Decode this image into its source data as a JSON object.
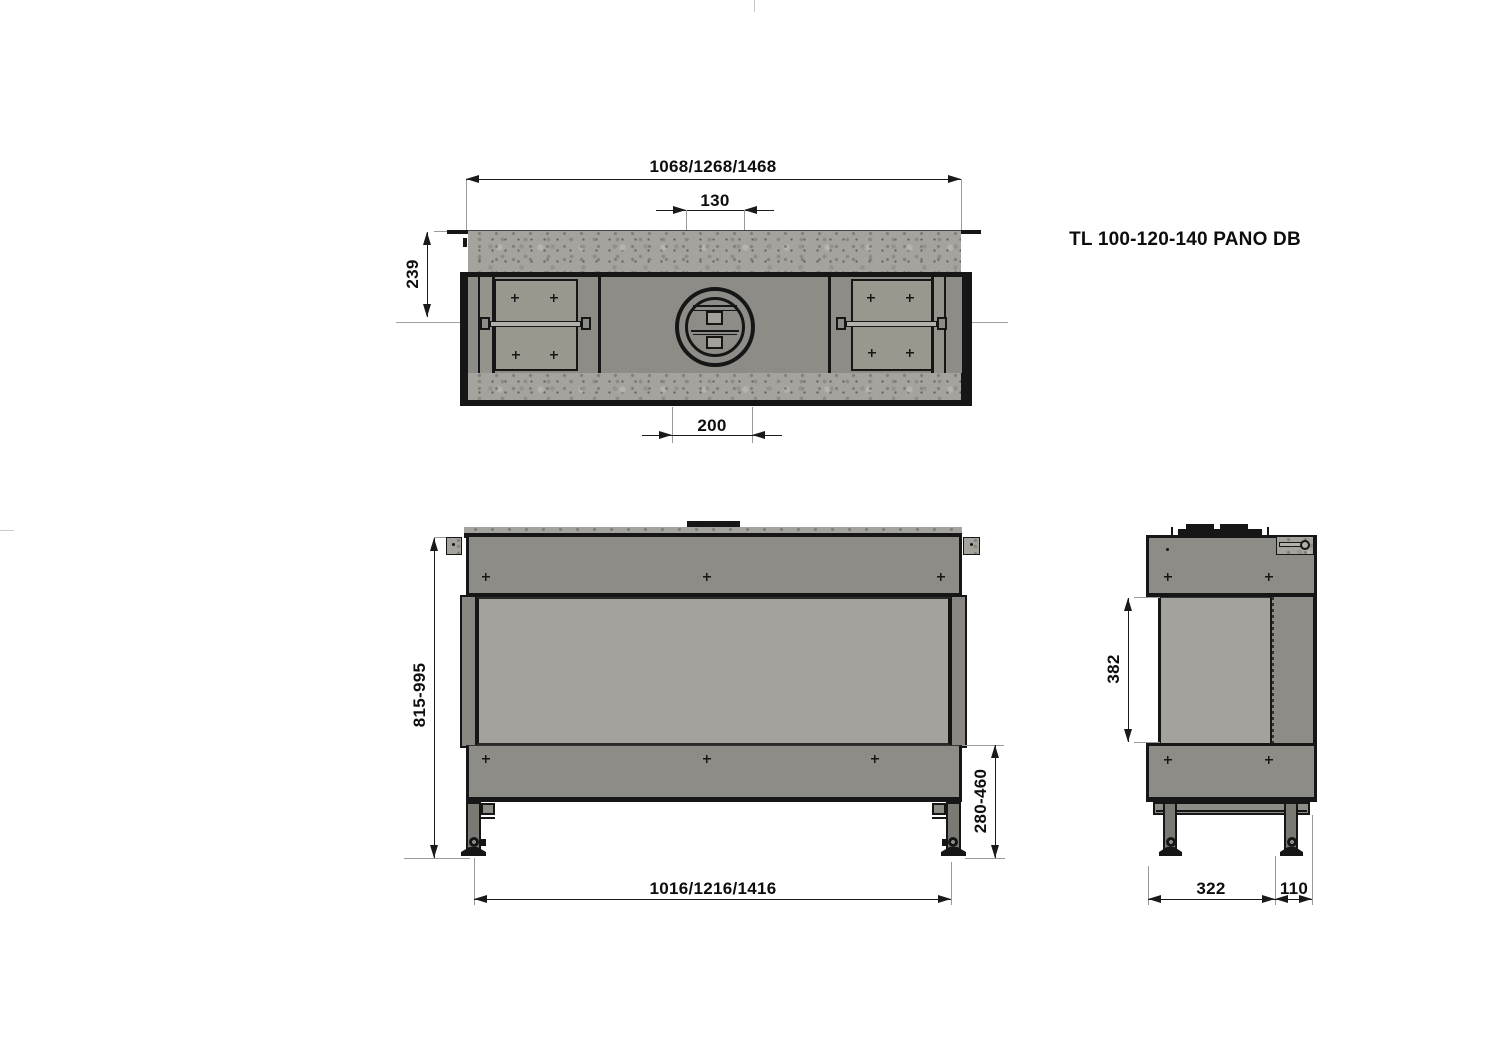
{
  "title": "TL 100-120-140 PANO DB",
  "top_view": {
    "overall_width": "1068/1268/1468",
    "flue_offset": "130",
    "depth_to_axis": "239",
    "flue_cutout_width": "200"
  },
  "front_view": {
    "overall_height": "815-995",
    "base_height": "280-460",
    "feet_span_width": "1016/1216/1416"
  },
  "side_view": {
    "glass_height": "382",
    "front_depth": "322",
    "rear_depth": "110"
  },
  "colors": {
    "body_gray": "#8e8c87",
    "glass_gray": "#a4a29c",
    "panel_gray": "#9a978f",
    "concrete_gray": "#a5a39d",
    "line_black": "#161616",
    "background": "#ffffff"
  }
}
